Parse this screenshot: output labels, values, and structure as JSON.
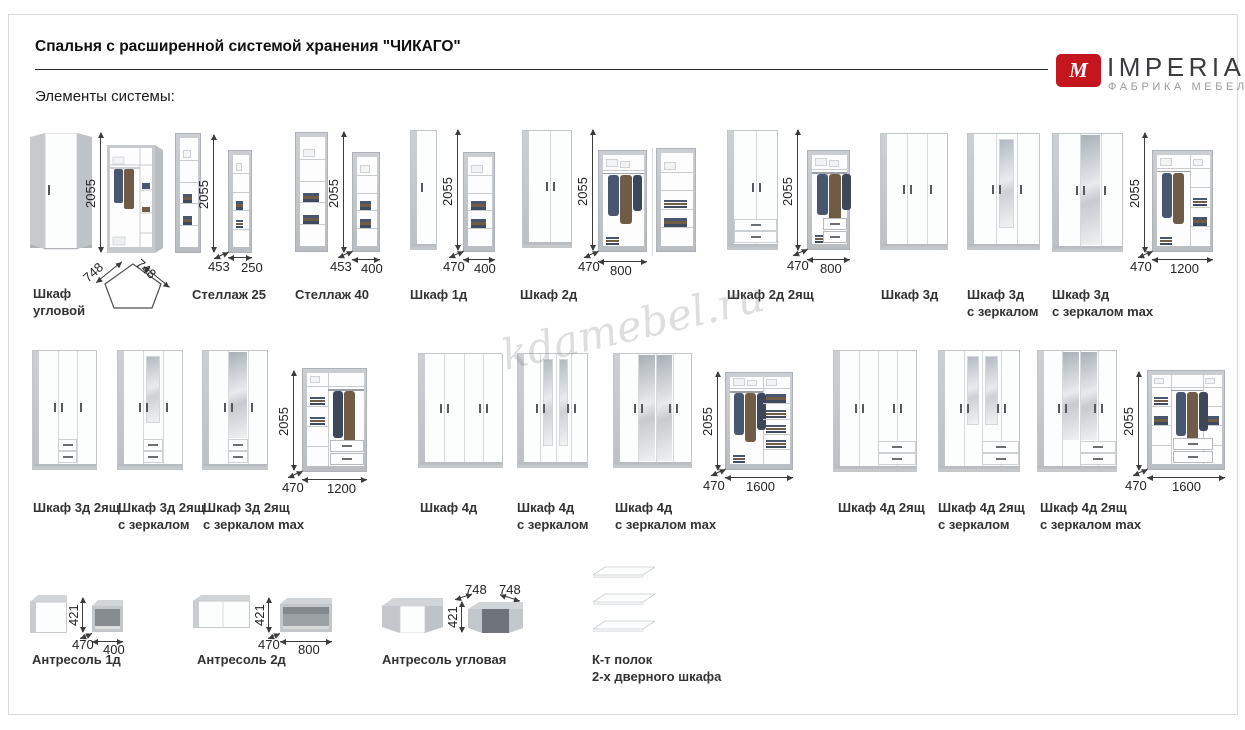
{
  "page": {
    "title": "Спальня с расширенной системой хранения \"ЧИКАГО\"",
    "section_label": "Элементы системы:"
  },
  "logo": {
    "monogram": "M",
    "brand": "IMPERIAL",
    "tagline": "ФАБРИКА МЕБЕЛИ",
    "accent": "#c4161c"
  },
  "watermark": "kdamebel.ru",
  "colors": {
    "accent_red": "#c4161c",
    "concrete_gray": "#c3c7cb",
    "caption_text": "#333333"
  },
  "groups": {
    "uglovoy": {
      "label": [
        "Шкаф",
        "угловой"
      ],
      "h": "2055",
      "a": "748",
      "b": "748"
    },
    "st25": {
      "label": [
        "Стеллаж 25"
      ],
      "h": "2055",
      "d": "453",
      "w": "250"
    },
    "st40": {
      "label": [
        "Стеллаж 40"
      ],
      "h": "2055",
      "d": "453",
      "w": "400"
    },
    "s1d": {
      "label": [
        "Шкаф 1д"
      ],
      "h": "2055",
      "d": "470",
      "w": "400"
    },
    "s2d": {
      "label": [
        "Шкаф 2д"
      ],
      "h": "2055",
      "d": "470",
      "w": "800"
    },
    "s2d2": {
      "label": [
        "Шкаф 2д 2ящ"
      ],
      "h": "2055",
      "d": "470",
      "w": "800"
    },
    "s3d": {
      "label": [
        "Шкаф 3д"
      ]
    },
    "s3dz": {
      "label": [
        "Шкаф 3д",
        "с зеркалом"
      ]
    },
    "s3dzm": {
      "label": [
        "Шкаф 3д",
        "с зеркалом max"
      ]
    },
    "s3open": {
      "h": "2055",
      "d": "470",
      "w": "1200"
    },
    "s3d2": {
      "label": [
        "Шкаф 3д 2ящ"
      ]
    },
    "s3d2z": {
      "label": [
        "Шкаф 3д 2ящ",
        "с зеркалом"
      ]
    },
    "s3d2zm": {
      "label": [
        "Шкаф 3д 2ящ",
        "с зеркалом max"
      ]
    },
    "s32open": {
      "h": "2055",
      "d": "470",
      "w": "1200"
    },
    "s4d": {
      "label": [
        "Шкаф 4д"
      ]
    },
    "s4dz": {
      "label": [
        "Шкаф 4д",
        "с зеркалом"
      ]
    },
    "s4dzm": {
      "label": [
        "Шкаф 4д",
        "с зеркалом max"
      ]
    },
    "s4open": {
      "h": "2055",
      "d": "470",
      "w": "1600"
    },
    "s4d2": {
      "label": [
        "Шкаф 4д 2ящ"
      ]
    },
    "s4d2z": {
      "label": [
        "Шкаф 4д 2ящ",
        "с зеркалом"
      ]
    },
    "s4d2zm": {
      "label": [
        "Шкаф 4д 2ящ",
        "с зеркалом max"
      ]
    },
    "s42open": {
      "h": "2055",
      "d": "470",
      "w": "1600"
    },
    "a1d": {
      "label": [
        "Антресоль 1д"
      ],
      "h": "421",
      "d": "470",
      "w": "400"
    },
    "a2d": {
      "label": [
        "Антресоль 2д"
      ],
      "h": "421",
      "d": "470",
      "w": "800"
    },
    "au": {
      "label": [
        "Антресоль угловая"
      ],
      "h": "421",
      "a": "748",
      "b": "748"
    },
    "polki": {
      "label": [
        "К-т полок",
        "2-х дверного шкафа"
      ]
    }
  }
}
